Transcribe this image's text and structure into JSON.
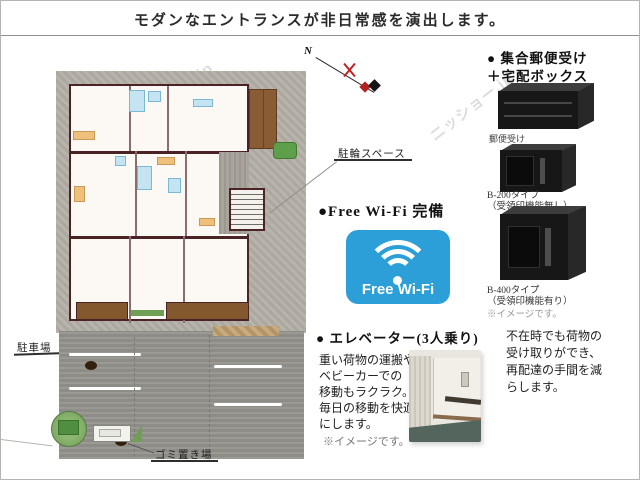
{
  "title": "モダンなエントランスが非日常常感を演出します。",
  "title_text": "モダンなエントランスが非日常感を演出します。",
  "watermark_text": "ニッショー.jp",
  "site_plan": {
    "north_label": "N",
    "bicycle_label": "駐輪スペース",
    "parking_label": "駐車場",
    "garbage_label": "ゴミ置き場"
  },
  "mailbox_section": {
    "heading_line1": "● 集合郵便受け",
    "heading_line2": "＋宅配ボックス",
    "mailbox_caption": "郵便受け",
    "box1_name": "B-200タイプ",
    "box1_note": "（受領印機能無し）",
    "box2_name": "B-400タイプ",
    "box2_note": "（受領印機能有り）",
    "image_note": "※イメージです。",
    "description_lines": [
      "不在時でも荷物の",
      "受け取りができ、",
      "再配達の手間を減",
      "らします。"
    ]
  },
  "wifi_section": {
    "heading": "●Free Wi-Fi 完備",
    "badge_label": "Free Wi-Fi",
    "badge_color": "#2d9fd8"
  },
  "elevator_section": {
    "heading": "● エレベーター(3人乗り)",
    "description_lines": [
      "重い荷物の運搬や",
      "ベビーカーでの",
      "移動もラクラク。",
      "毎日の移動を快適",
      "にします。"
    ],
    "image_note": "※イメージです。"
  }
}
